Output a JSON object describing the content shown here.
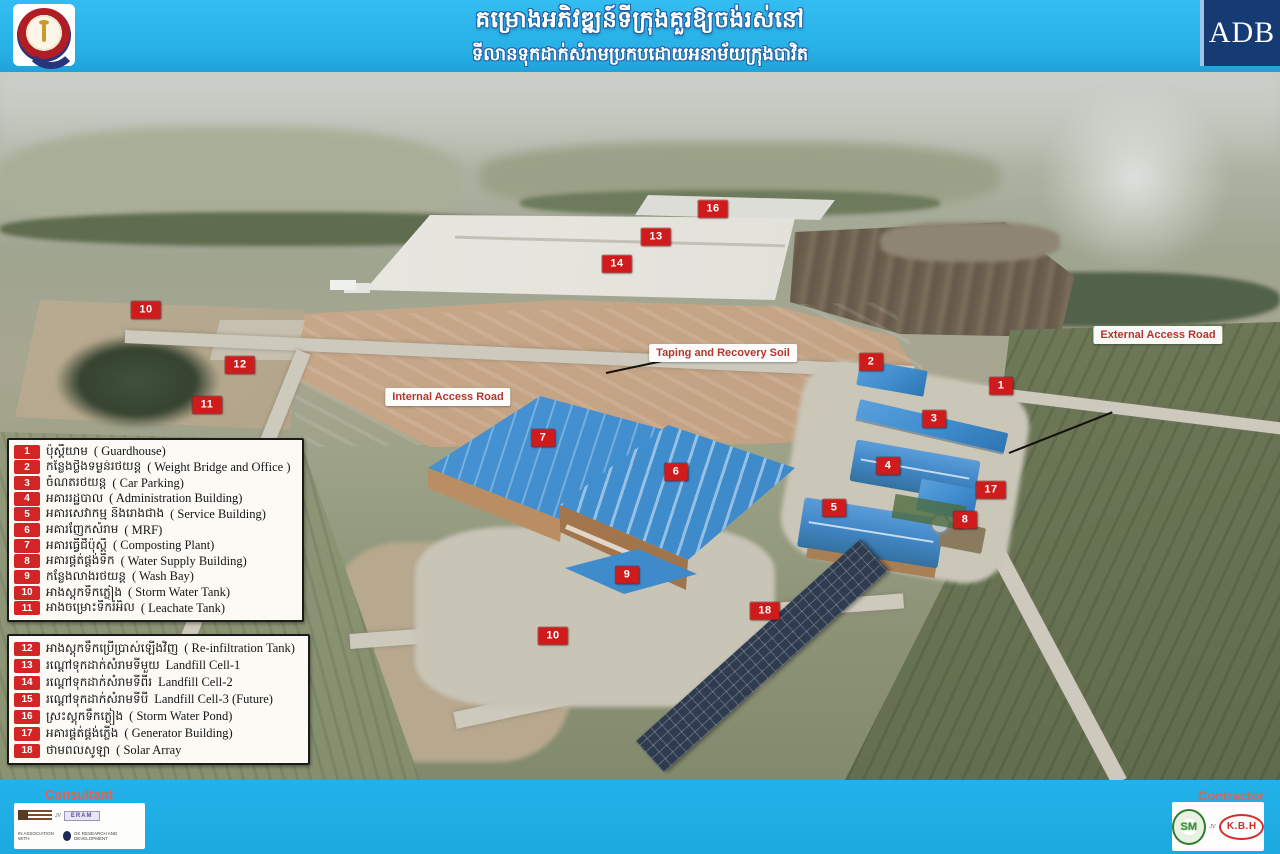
{
  "header": {
    "title_line1": "គម្រោងអភិវឌ្ឍន៍ទីក្រុងគួរឱ្យចង់រស់នៅ",
    "title_line2": "ទីលានទុកដាក់សំរាមប្រកបដោយអនាម័យក្រុងបាវិត",
    "adb_text": "ADB"
  },
  "photo_labels": {
    "internal_access_road": "Internal Access Road",
    "taping_recovery": "Taping and Recovery Soil",
    "external_access_road": "External Access Road"
  },
  "markers": [
    {
      "num": "16",
      "x": 713,
      "y": 209
    },
    {
      "num": "13",
      "x": 656,
      "y": 237
    },
    {
      "num": "14",
      "x": 617,
      "y": 264
    },
    {
      "num": "10",
      "x": 146,
      "y": 310
    },
    {
      "num": "12",
      "x": 240,
      "y": 365
    },
    {
      "num": "11",
      "x": 207,
      "y": 405
    },
    {
      "num": "2",
      "x": 871,
      "y": 362
    },
    {
      "num": "1",
      "x": 1001,
      "y": 386
    },
    {
      "num": "3",
      "x": 934,
      "y": 419
    },
    {
      "num": "7",
      "x": 543,
      "y": 438
    },
    {
      "num": "4",
      "x": 888,
      "y": 466
    },
    {
      "num": "6",
      "x": 676,
      "y": 472
    },
    {
      "num": "17",
      "x": 991,
      "y": 490
    },
    {
      "num": "5",
      "x": 834,
      "y": 508
    },
    {
      "num": "8",
      "x": 965,
      "y": 520
    },
    {
      "num": "9",
      "x": 627,
      "y": 575
    },
    {
      "num": "18",
      "x": 765,
      "y": 611
    },
    {
      "num": "10",
      "x": 553,
      "y": 636
    }
  ],
  "legend1": {
    "items": [
      {
        "num": "1",
        "km": "ប៉ុស្តិ៍យាម",
        "en": "( Guardhouse)"
      },
      {
        "num": "2",
        "km": "កន្លែងថ្លឹងទម្ងន់រថយន្ត",
        "en": "( Weight Bridge and Office )"
      },
      {
        "num": "3",
        "km": "ចំណតរថយន្ត",
        "en": "( Car Parking)"
      },
      {
        "num": "4",
        "km": "អគាររដ្ឋបាល",
        "en": "( Administration Building)"
      },
      {
        "num": "5",
        "km": "អគារសេវាកម្ម និងរោងជាង",
        "en": "( Service Building)"
      },
      {
        "num": "6",
        "km": "អគារញែកសំរាម",
        "en": "( MRF)"
      },
      {
        "num": "7",
        "km": "អគារធ្វើជីប៉ុស្តិ៍",
        "en": "( Composting Plant)"
      },
      {
        "num": "8",
        "km": "អគារផ្គត់ផ្គង់ទឹក",
        "en": "( Water Supply Building)"
      },
      {
        "num": "9",
        "km": "កន្លែងលាងរថយន្ត",
        "en": "( Wash Bay)"
      },
      {
        "num": "10",
        "km": "អាងស្តុកទឹកភ្លៀង",
        "en": "( Storm Water Tank)"
      },
      {
        "num": "11",
        "km": "អាងចម្រោះទឹករំអិល",
        "en": "( Leachate Tank)"
      }
    ]
  },
  "legend2": {
    "items": [
      {
        "num": "12",
        "km": "អាងស្តុកទឹកប្រើប្រាស់ឡើងវិញ",
        "en": "( Re-infiltration Tank)"
      },
      {
        "num": "13",
        "km": "រណ្តៅទុកដាក់សំរាមទីមួយ",
        "en": "Landfill Cell-1"
      },
      {
        "num": "14",
        "km": "រណ្តៅទុកដាក់សំរាមទីពីរ",
        "en": "Landfill Cell-2"
      },
      {
        "num": "15",
        "km": "រណ្តៅទុកដាក់សំរាមទីបី",
        "en": "Landfill Cell-3 (Future)"
      },
      {
        "num": "16",
        "km": "ស្រះស្តុកទឹកភ្លៀង",
        "en": "( Storm Water Pond)"
      },
      {
        "num": "17",
        "km": "អគារផ្គត់ផ្គង់ភ្លើង",
        "en": "( Generator Building)"
      },
      {
        "num": "18",
        "km": "ថាមពលសូឡា",
        "en": "( Solar Array"
      }
    ]
  },
  "footer": {
    "consultant_label": "Consultant",
    "contractor_label": "Contractor",
    "consultant": {
      "jv": "JV",
      "logo2": "ERAM",
      "assoc": "IN ASSOCIATION WITH",
      "partner": "GK RESEARCH AND DEVELOPMENT"
    },
    "contractor": {
      "logo1": "SM",
      "jv": "JV",
      "logo2": "K.B.H"
    }
  },
  "colors": {
    "header_bg": "#29b3e8",
    "adb_navy": "#163a74",
    "marker_red": "#cf1b1b",
    "label_red": "#b3362e",
    "legend_chip_red": "#d32525"
  }
}
